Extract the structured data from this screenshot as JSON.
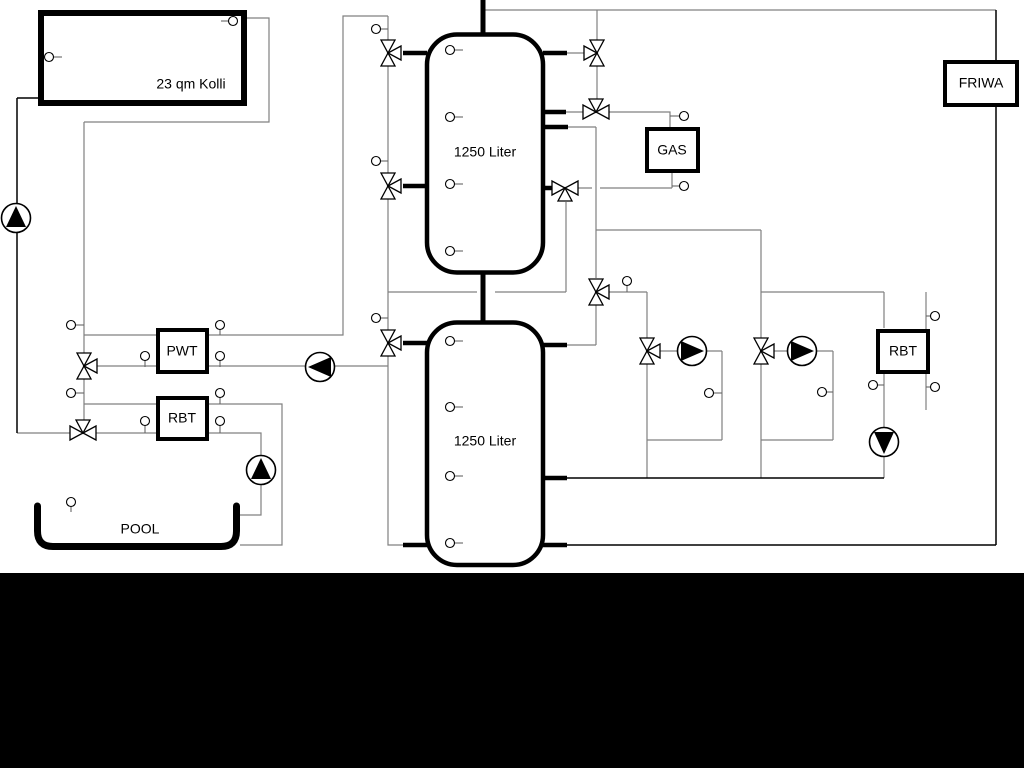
{
  "labels": {
    "collector": "23 qm Kolli",
    "tank_top": "1250 Liter",
    "tank_bottom": "1250 Liter",
    "gas": "GAS",
    "friwa": "FRIWA",
    "pwt": "PWT",
    "rbt_left": "RBT",
    "rbt_right": "RBT",
    "pool": "POOL"
  },
  "colors": {
    "background": "#ffffff",
    "pipe_gray": "#808080",
    "pipe_black": "#000000",
    "symbol_fill": "#ffffff",
    "bottom_bar": "#000000"
  },
  "components": {
    "heat_sources": [
      "solar collector 23 qm Kolli",
      "GAS boiler"
    ],
    "storage": [
      "buffer tank 1250 Liter (upper)",
      "buffer tank 1250 Liter (lower)"
    ],
    "heat_exchangers": [
      "PWT",
      "RBT (pool side)",
      "RBT (right circuit)"
    ],
    "consumers": [
      "FRIWA fresh water station",
      "POOL",
      "heating circuit 1",
      "heating circuit 2"
    ],
    "pumps": [
      {
        "name": "solar-pump",
        "direction": "up"
      },
      {
        "name": "pwt-charge-pump",
        "direction": "left"
      },
      {
        "name": "pool-pump",
        "direction": "up"
      },
      {
        "name": "heating-circuit-1-pump",
        "direction": "right"
      },
      {
        "name": "heating-circuit-2-pump",
        "direction": "right"
      },
      {
        "name": "rbt-circuit-pump",
        "direction": "down"
      }
    ],
    "three_way_valves": 11,
    "temperature_sensors": 30
  }
}
